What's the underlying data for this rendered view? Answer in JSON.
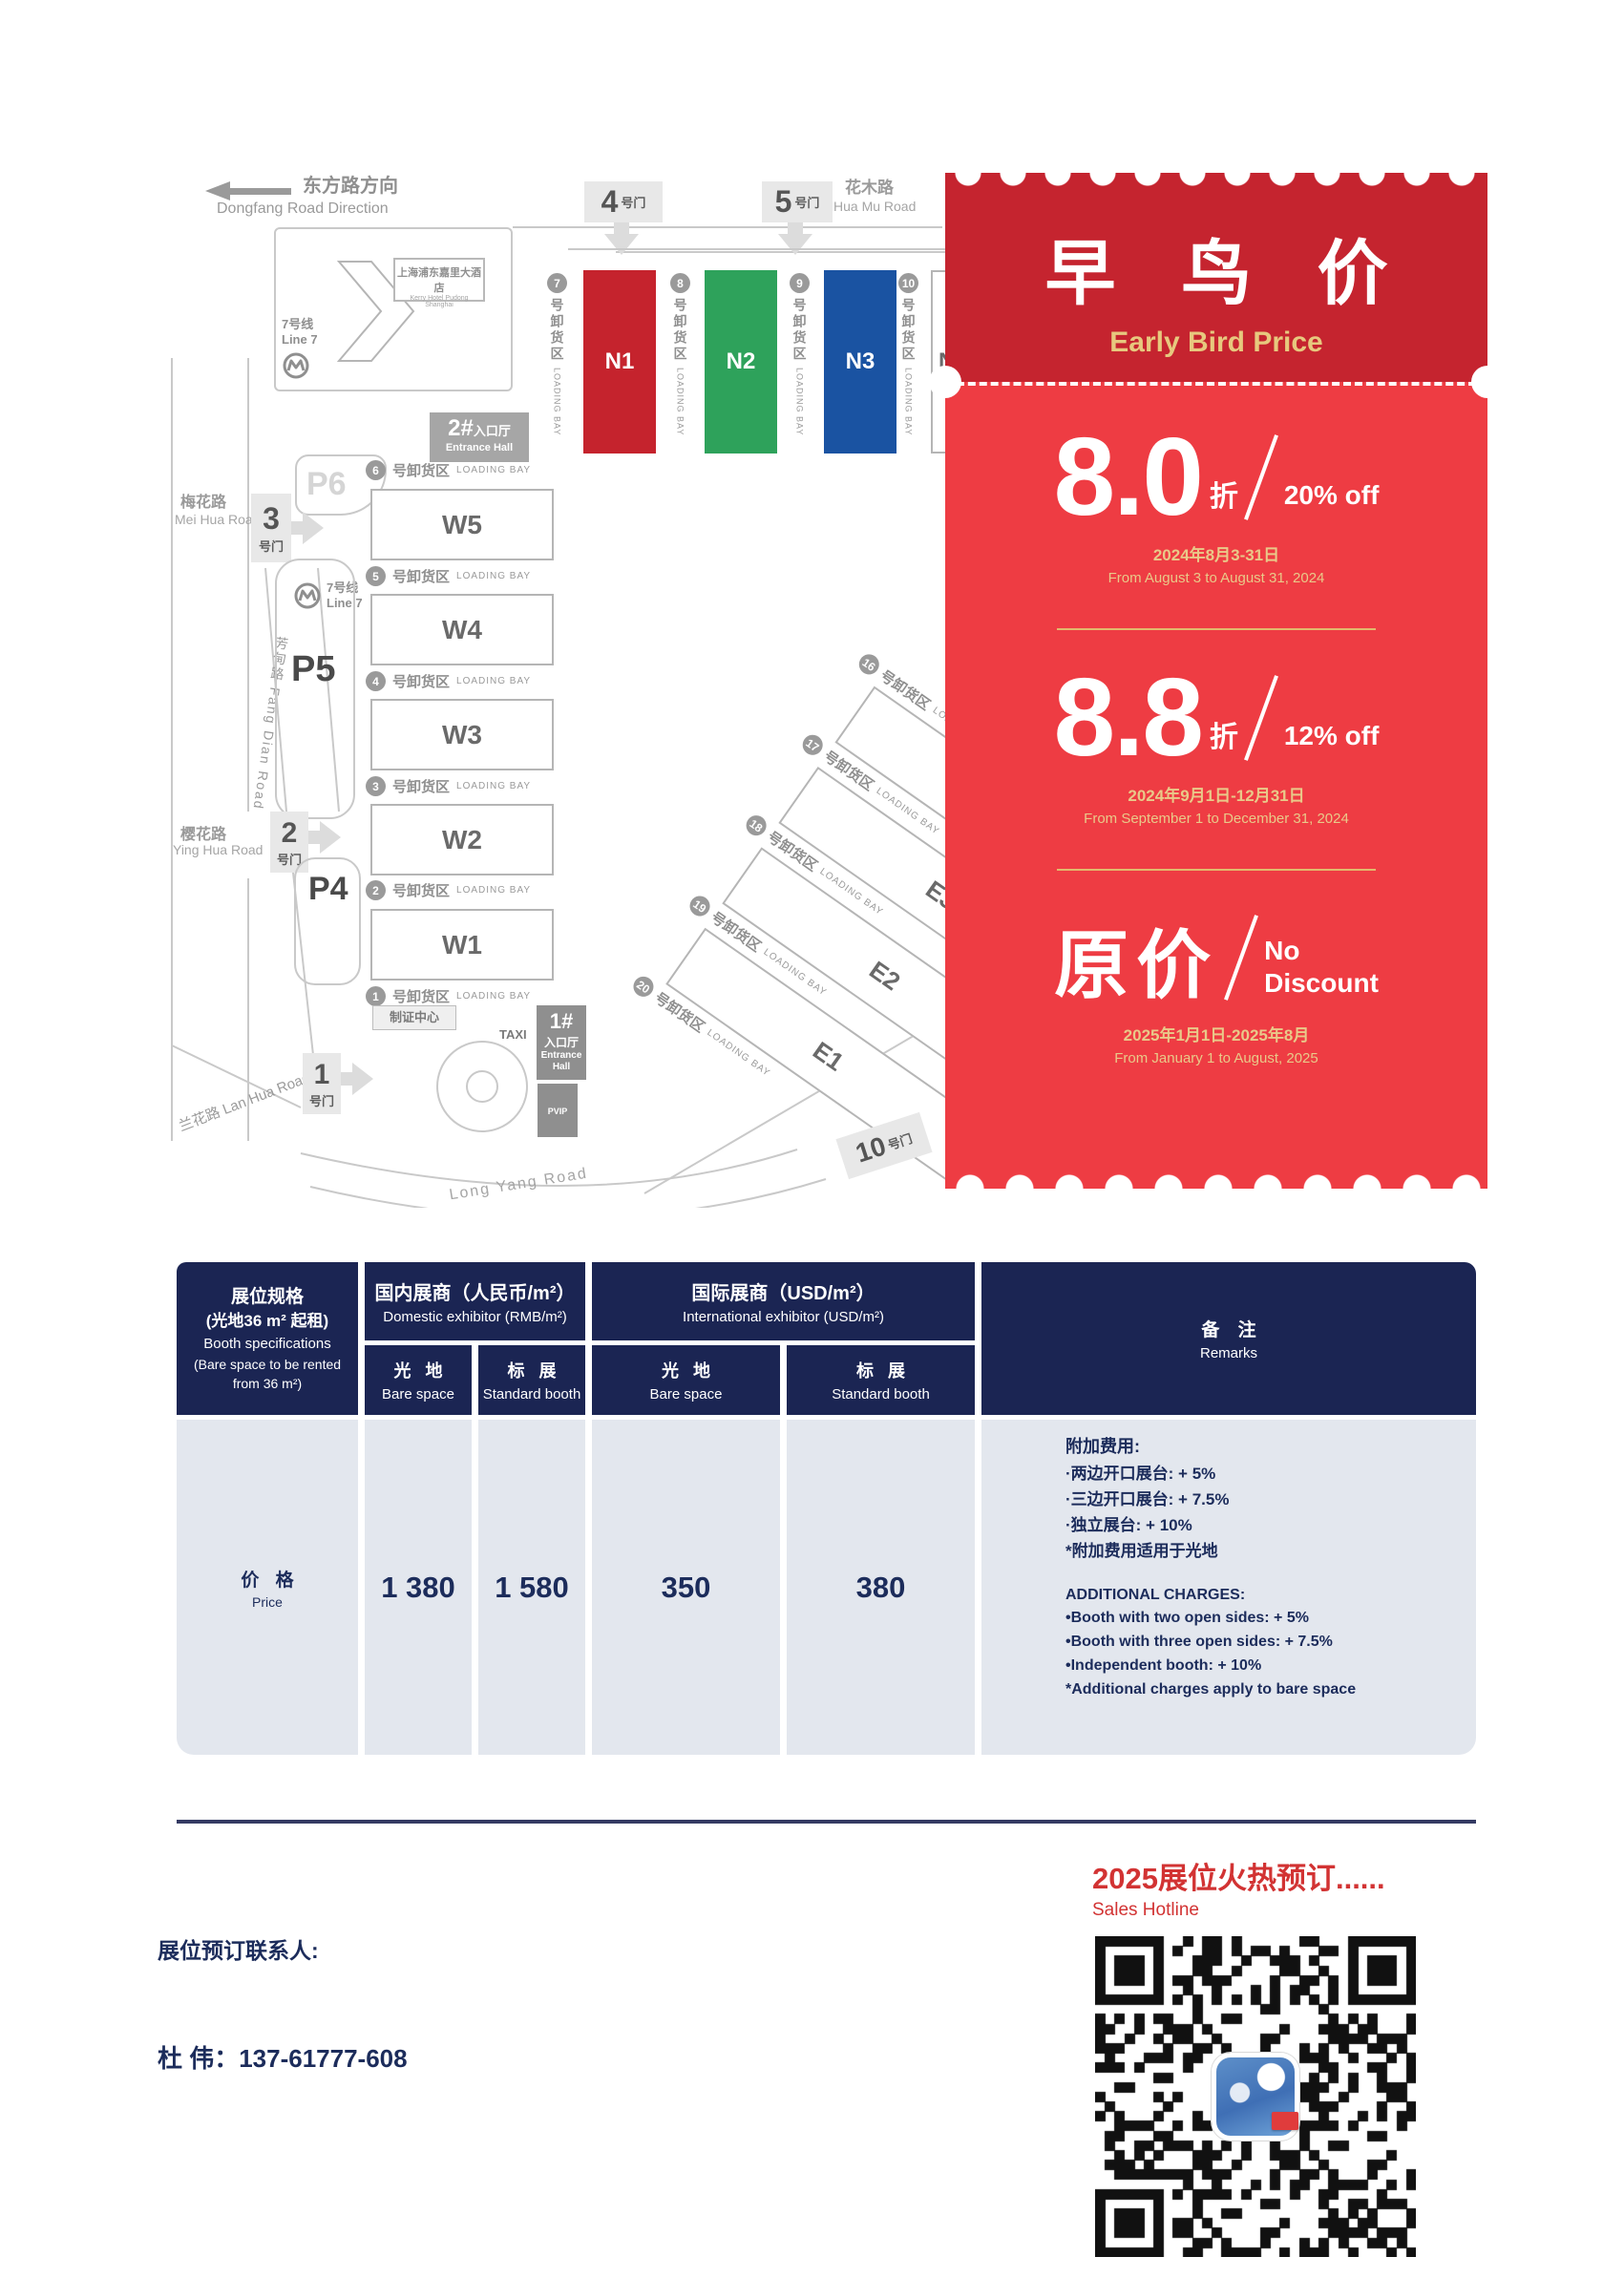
{
  "map": {
    "direction": {
      "zh": "东方路方向",
      "en": "Dongfang Road Direction"
    },
    "huamu": {
      "zh": "花木路",
      "en": "Hua Mu Road"
    },
    "meihua": {
      "zh": "梅花路",
      "en": "Mei Hua Road"
    },
    "yinghua": {
      "zh": "樱花路",
      "en": "Ying Hua Road"
    },
    "lanhua": {
      "full": "兰花路  Lan Hua Road"
    },
    "fangdian": {
      "full": "芳甸路  Fang Dian Road"
    },
    "longyang": {
      "en": "Long Yang Road"
    },
    "metro": {
      "zh": "7号线",
      "en": "Line 7"
    },
    "hotel": {
      "zh": "上海浦东嘉里大酒店",
      "en": "Kerry Hotel Pudong Shanghai"
    },
    "badge_center": "制证中心",
    "taxi": "TAXI",
    "entrance_zh": "入口厅",
    "entrance_en": "Entrance Hall",
    "entrance_en1": "Entrance",
    "entrance_en2": "Hall",
    "e1_num": "1#",
    "e2_num": "2#",
    "parking": {
      "p4": "P4",
      "p5": "P5",
      "p6": "P6",
      "p": "P",
      "vip": "VIP"
    },
    "gate_suffix": "号门",
    "gates": {
      "g1": "1",
      "g2": "2",
      "g3": "3",
      "g4": "4",
      "g5": "5",
      "g10": "10"
    },
    "bay": {
      "zh": "号卸货区",
      "en": "LOADING BAY"
    },
    "n_bays": [
      "7",
      "8",
      "9",
      "10"
    ],
    "w_bays": [
      "6",
      "5",
      "4",
      "3",
      "2",
      "1"
    ],
    "e_bays": [
      "16",
      "17",
      "18",
      "19",
      "20"
    ],
    "n_halls": [
      "N1",
      "N2",
      "N3",
      "N4"
    ],
    "w_halls": [
      "W5",
      "W4",
      "W3",
      "W2",
      "W1"
    ],
    "e_halls": [
      "E4",
      "E3",
      "E2",
      "E1"
    ]
  },
  "coupon": {
    "title_zh": "早 鸟 价",
    "title_en": "Early Bird Price",
    "tier1": {
      "num": "8.0",
      "unit": "折",
      "off": "20% off",
      "date_zh": "2024年8月3-31日",
      "date_en": "From August 3 to August 31, 2024"
    },
    "tier2": {
      "num": "8.8",
      "unit": "折",
      "off": "12% off",
      "date_zh": "2024年9月1日-12月31日",
      "date_en": "From September 1 to December 31, 2024"
    },
    "tier3": {
      "num": "原价",
      "off_line1": "No",
      "off_line2": "Discount",
      "date_zh": "2025年1月1日-2025年8月",
      "date_en": "From January 1 to August, 2025"
    }
  },
  "table": {
    "col1": {
      "zh1": "展位规格",
      "zh2": "(光地36 m² 起租)",
      "en1": "Booth specifications",
      "en2": "(Bare space to be rented",
      "en3": "from 36 m²)"
    },
    "domestic": {
      "zh": "国内展商（人民币/m²）",
      "en": "Domestic exhibitor (RMB/m²)"
    },
    "international": {
      "zh": "国际展商（USD/m²）",
      "en": "International exhibitor (USD/m²)"
    },
    "sub_bare": {
      "zh": "光 地",
      "en": "Bare space"
    },
    "sub_std": {
      "zh": "标 展",
      "en": "Standard booth"
    },
    "remarks": {
      "zh": "备 注",
      "en": "Remarks"
    },
    "price_label": {
      "zh": "价 格",
      "en": "Price"
    },
    "values": [
      "1 380",
      "1 580",
      "350",
      "380"
    ],
    "remarks_zh": {
      "title": "附加费用:",
      "l1": "·两边开口展台: + 5%",
      "l2": "·三边开口展台: + 7.5%",
      "l3": "·独立展台: + 10%",
      "l4": "*附加费用适用于光地"
    },
    "remarks_en": {
      "title": "ADDITIONAL CHARGES:",
      "l1": "•Booth with two open sides: + 5%",
      "l2": "•Booth with three open sides: + 7.5%",
      "l3": "•Independent booth: + 10%",
      "l4": "*Additional charges apply to bare space"
    }
  },
  "footer": {
    "hotline_zh": "2025展位火热预订......",
    "hotline_en": "Sales Hotline",
    "contact_label": "展位预订联系人:",
    "contact": "杜  伟：137-61777-608"
  },
  "colors": {
    "panel_dark_red": "#c5242f",
    "panel_red": "#ee3c43",
    "title_gold": "#e7c87e",
    "date_gold": "#e9c989",
    "navy": "#1b2553",
    "table_cell_bg": "#e3e7ee",
    "hall_red": "#c5232d",
    "hall_green": "#2ea25b",
    "hall_blue": "#1a53a2",
    "hotline_red": "#d23333",
    "map_gray": "#9a9a9a"
  }
}
